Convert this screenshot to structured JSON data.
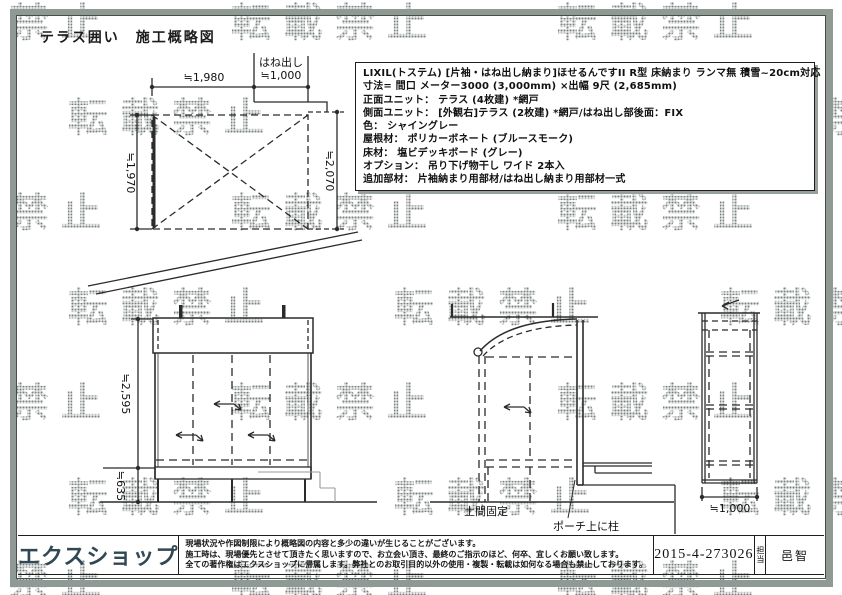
{
  "page": {
    "title": "テラス囲い　施工概略図",
    "watermark_text": "転載禁止"
  },
  "spec_box": {
    "lines": [
      "LIXIL(トステム) [片袖・はね出し納まり]ほせるんですII R型 床納まり ランマ無 積雪~20cm対応",
      "寸法= 間口 メーター3000 (3,000mm) ×出幅 9尺 (2,685mm)",
      "正面ユニット： テラス (4枚建) *網戸",
      "側面ユニット： [外観右]テラス (2枚建) *網戸/はね出し部後面：FIX",
      "色： シャイングレー",
      "屋根材： ポリカーボネート (ブルースモーク)",
      "床材： 塩ビデッキボード (グレー)",
      "オプション： 吊り下げ物干し ワイド 2本入",
      "追加部材： 片袖納まり用部材/はね出し納まり用部材一式"
    ]
  },
  "plan_view": {
    "dim_width": "≒1,980",
    "overhang_label": "はね出し",
    "overhang_dim": "≒1,000",
    "dim_depth_left": "≒1,970",
    "dim_depth_right": "≒2,070"
  },
  "front_view": {
    "dim_height_upper": "≒2,595",
    "dim_height_lower": "≒635"
  },
  "side_view": {
    "ground_label": "土間固定",
    "porch_label": "ポーチ上に柱"
  },
  "rear_view": {
    "dim_width": "≒1,000"
  },
  "footer": {
    "logo": "エクスショップ",
    "disclaimer": [
      "現場状況や作図制限により概略図の内容と多少の違いが生じることがございます。",
      "施工時は、現場優先とさせて頂きたく思いますので、お立会い頂き、最終のご指示のほど、何卒、宜しくお願い致します。",
      "全ての著作権はエクスショップに帰属します。弊社とのお取引目的以外の使用・複製・転載は如何なる場合も禁止しております。"
    ],
    "order_number": "2015-4-273026",
    "staff_label": "担当",
    "staff_name": "邑智"
  },
  "colors": {
    "frame": "#8f9a94",
    "frame_inner_line": "#454e49",
    "drawing_line": "#2b2b2b",
    "gray_line": "#9a9a9a",
    "border_dark": "#1d1d1d",
    "logo": "#324754",
    "watermark_dot": "#7a8280"
  }
}
